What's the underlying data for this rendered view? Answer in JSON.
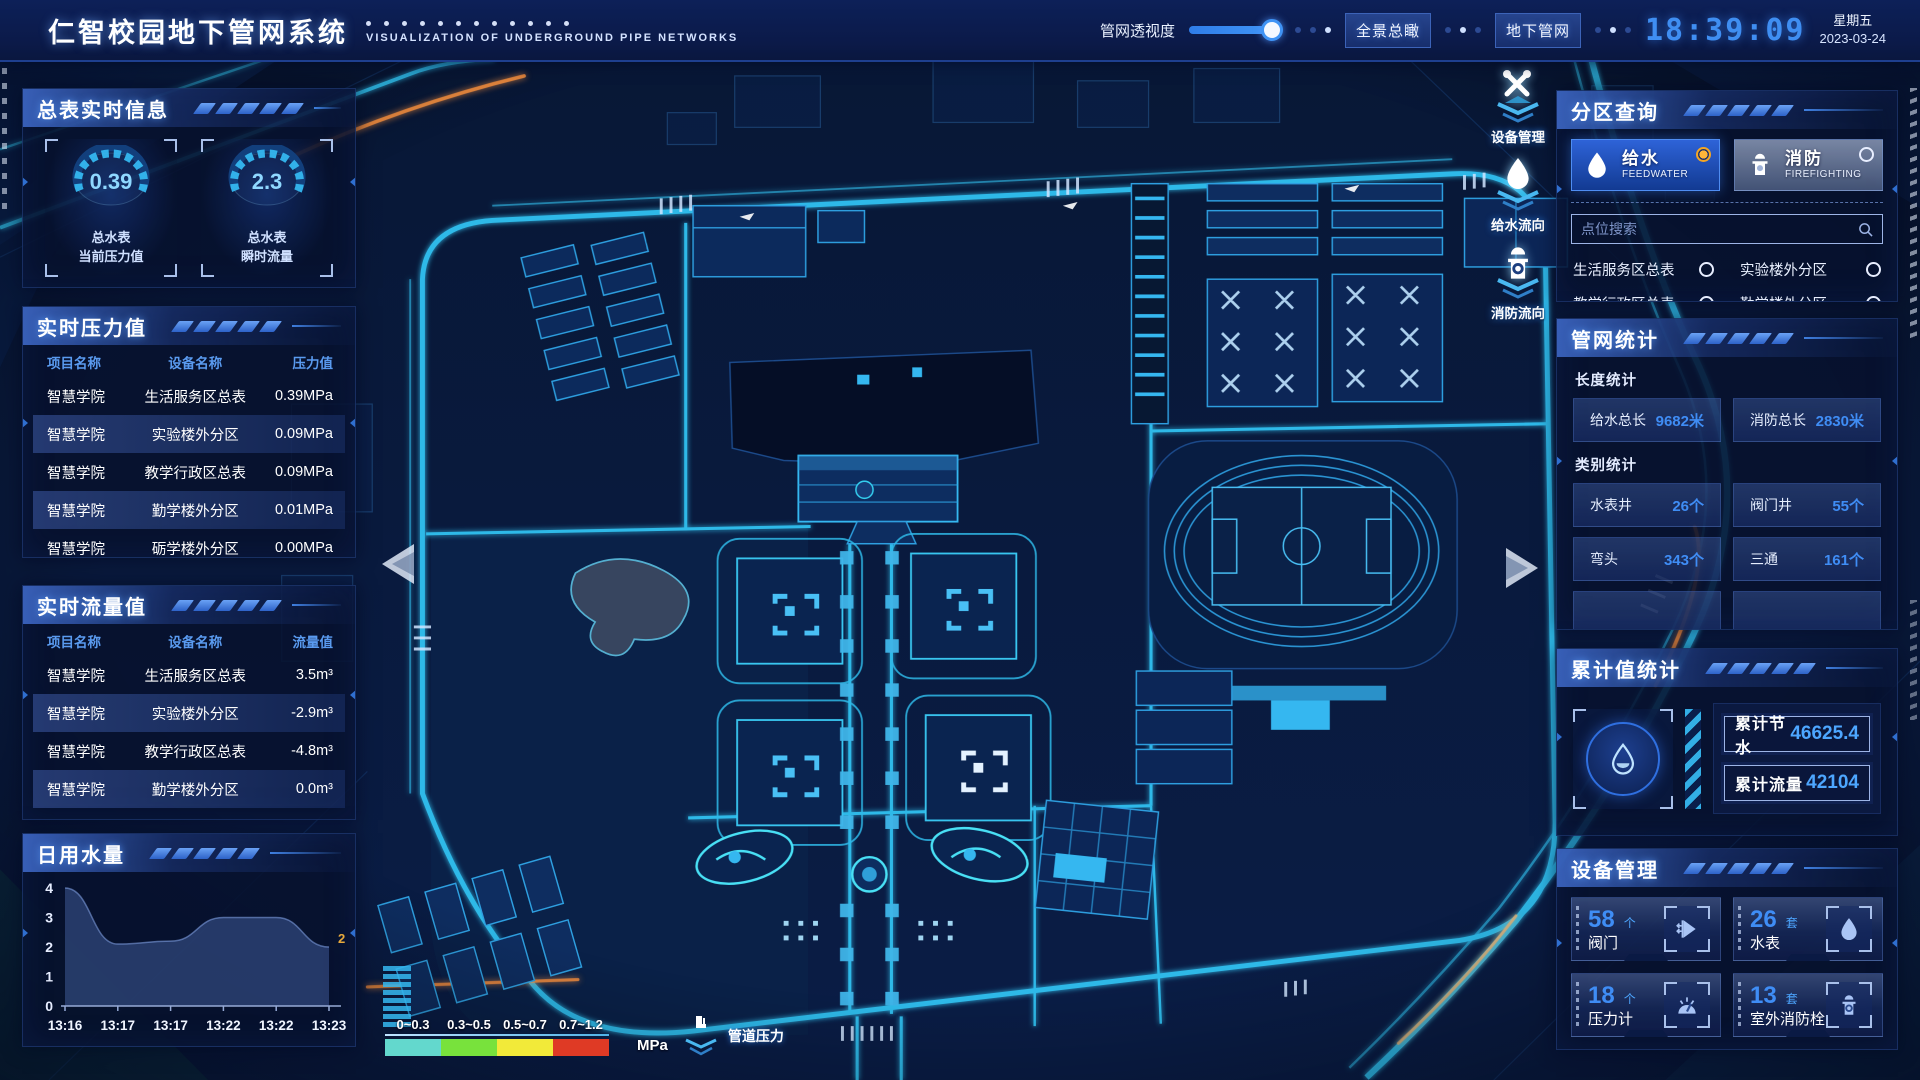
{
  "chart_data": {
    "type": "area",
    "title": "日用水量",
    "x": [
      "13:16",
      "13:17",
      "13:17",
      "13:22",
      "13:22",
      "13:23"
    ],
    "values": [
      4,
      2.1,
      2.2,
      3,
      3,
      2
    ],
    "ylim": [
      0,
      4
    ],
    "yticks": [
      0,
      1,
      2,
      3,
      4
    ],
    "end_label": "2",
    "grid": false,
    "legend": "none"
  },
  "header": {
    "title": "仁智校园地下管网系统",
    "subtitle": "VISUALIZATION OF UNDERGROUND PIPE NETWORKS",
    "slider_label": "管网透视度",
    "btn_overview": "全景总瞰",
    "btn_underground": "地下管网",
    "time": "18:39:09",
    "weekday": "星期五",
    "date": "2023-03-24"
  },
  "meter": {
    "title": "总表实时信息",
    "gauges": [
      {
        "value": "0.39",
        "line1": "总水表",
        "line2": "当前压力值"
      },
      {
        "value": "2.3",
        "line1": "总水表",
        "line2": "瞬时流量"
      }
    ]
  },
  "pressure": {
    "title": "实时压力值",
    "col1": "项目名称",
    "col2": "设备名称",
    "col3": "压力值",
    "rows": [
      [
        "智慧学院",
        "生活服务区总表",
        "0.39MPa"
      ],
      [
        "智慧学院",
        "实验楼外分区",
        "0.09MPa"
      ],
      [
        "智慧学院",
        "教学行政区总表",
        "0.09MPa"
      ],
      [
        "智慧学院",
        "勤学楼外分区",
        "0.01MPa"
      ],
      [
        "智慧学院",
        "砺学楼外分区",
        "0.00MPa"
      ]
    ]
  },
  "flow": {
    "title": "实时流量值",
    "col1": "项目名称",
    "col2": "设备名称",
    "col3": "流量值",
    "rows": [
      [
        "智慧学院",
        "生活服务区总表",
        "3.5m³"
      ],
      [
        "智慧学院",
        "实验楼外分区",
        "-2.9m³"
      ],
      [
        "智慧学院",
        "教学行政区总表",
        "-4.8m³"
      ],
      [
        "智慧学院",
        "勤学楼外分区",
        "0.0m³"
      ],
      [
        "智慧学院",
        "砺学楼外分区",
        "2.3m³"
      ]
    ]
  },
  "daily": {
    "title": "日用水量"
  },
  "zone": {
    "title": "分区查询",
    "modes": [
      {
        "label": "给水",
        "sub": "FEEDWATER",
        "selected": true
      },
      {
        "label": "消防",
        "sub": "FIREFIGHTING",
        "selected": false
      }
    ],
    "search_placeholder": "点位搜索",
    "options": [
      "生活服务区总表",
      "实验楼外分区",
      "教学行政区总表",
      "勤学楼外分区",
      "砺学楼外分区",
      "宿舍区泵房"
    ]
  },
  "network": {
    "title": "管网统计",
    "len_title": "长度统计",
    "cat_title": "类别统计",
    "len_stats": [
      {
        "label": "给水总长",
        "value": "9682米"
      },
      {
        "label": "消防总长",
        "value": "2830米"
      }
    ],
    "cat_stats": [
      {
        "label": "水表井",
        "value": "26个"
      },
      {
        "label": "阀门井",
        "value": "55个"
      },
      {
        "label": "弯头",
        "value": "343个"
      },
      {
        "label": "三通",
        "value": "161个"
      }
    ]
  },
  "total": {
    "title": "累计值统计",
    "items": [
      {
        "label": "累计节水",
        "value": "46625.4"
      },
      {
        "label": "累计流量",
        "value": "42104"
      }
    ]
  },
  "device": {
    "title": "设备管理",
    "items": [
      {
        "count": "58",
        "unit": "个",
        "name": "阀门",
        "icon": "valve-icon"
      },
      {
        "count": "26",
        "unit": "套",
        "name": "水表",
        "icon": "water-meter-icon"
      },
      {
        "count": "18",
        "unit": "个",
        "name": "压力计",
        "icon": "pressure-gauge-icon"
      },
      {
        "count": "13",
        "unit": "套",
        "name": "室外消防栓",
        "icon": "hydrant-icon"
      }
    ]
  },
  "map_tools": [
    {
      "label": "设备管理",
      "icon": "wrench-icon"
    },
    {
      "label": "给水流向",
      "icon": "water-drop-icon"
    },
    {
      "label": "消防流向",
      "icon": "hydrant-icon"
    }
  ],
  "legend": {
    "ranges": [
      "0~0.3",
      "0.3~0.5",
      "0.5~0.7",
      "0.7~1.2"
    ],
    "colors": [
      "#63d8cd",
      "#78e23c",
      "#f2ea39",
      "#df3a25"
    ],
    "unit": "MPa",
    "label": "管道压力"
  },
  "colors": {
    "accent_cyan": "#35b7f0",
    "value_blue": "#3f8df5",
    "alarm_orange": "#f5a623",
    "time_blue": "#3f8ef2"
  }
}
